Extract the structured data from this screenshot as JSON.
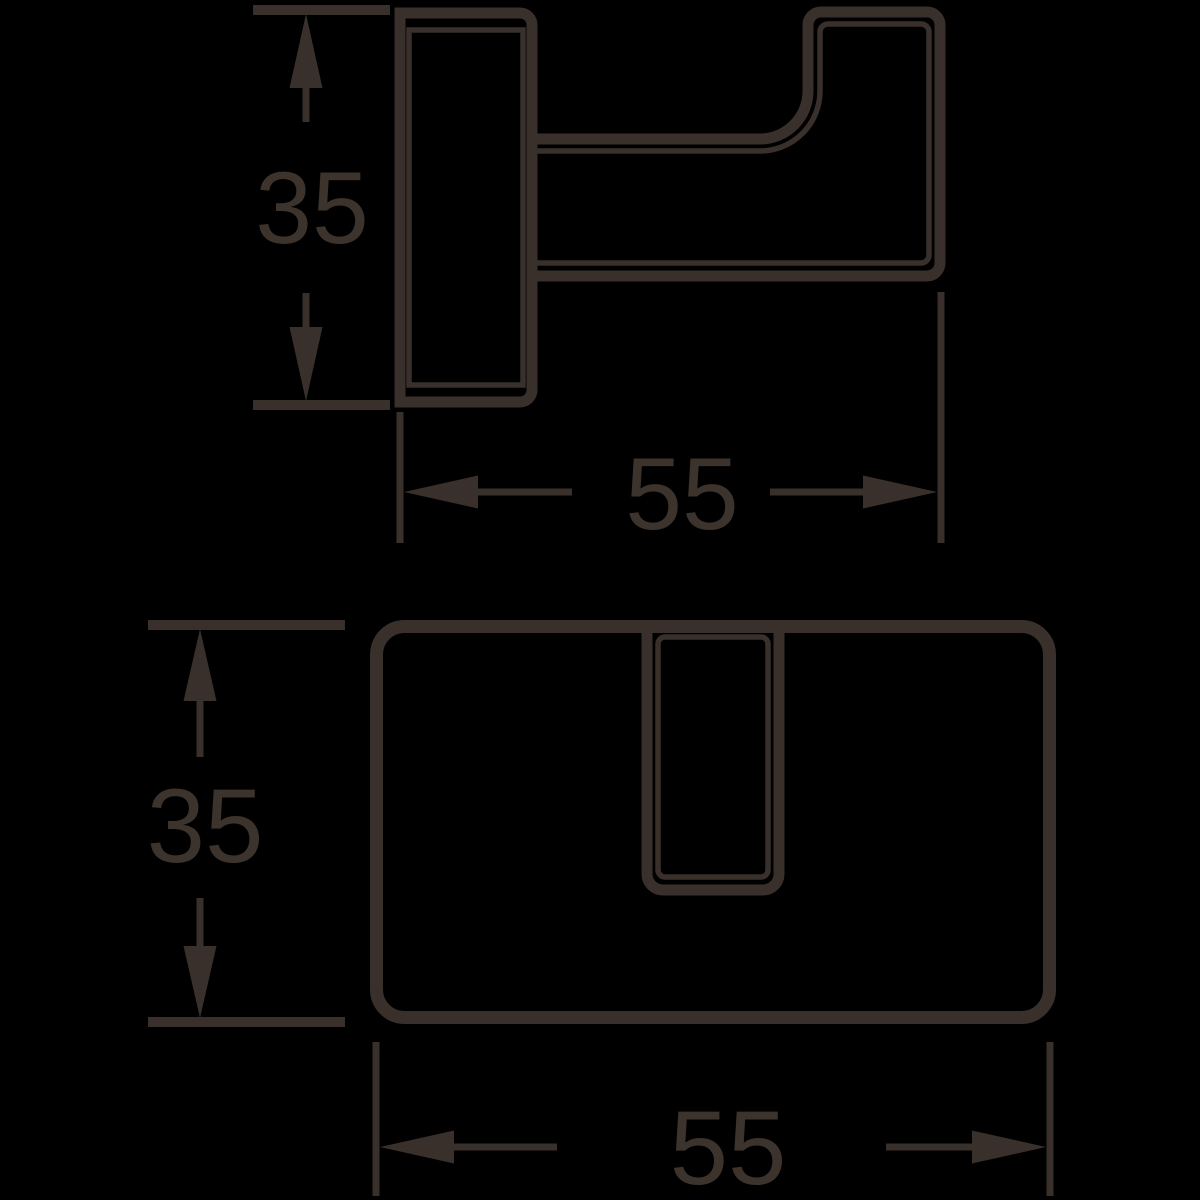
{
  "colors": {
    "line": "#39302b",
    "text": "#3c332d",
    "background": "#000000"
  },
  "dimensions": {
    "side_height": {
      "value": "35"
    },
    "side_depth": {
      "value": "55"
    },
    "front_height": {
      "value": "35"
    },
    "front_width": {
      "value": "55"
    }
  }
}
